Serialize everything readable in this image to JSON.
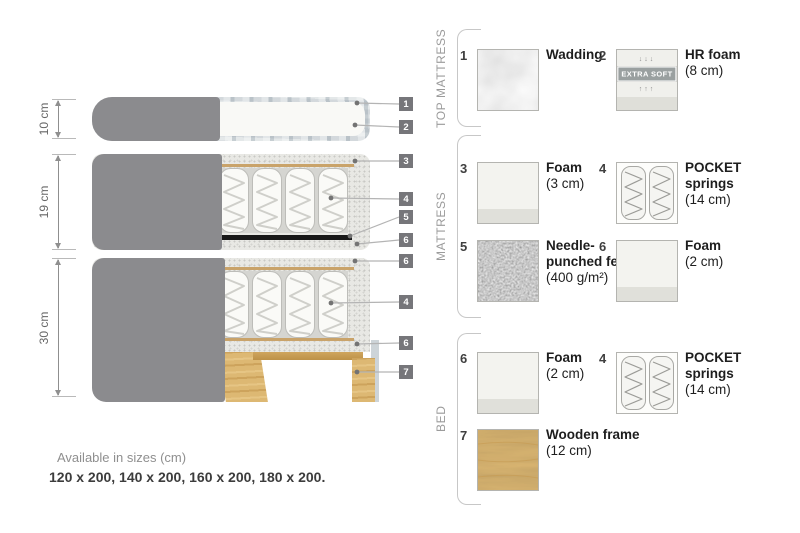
{
  "diagram": {
    "dims": [
      {
        "label": "10 cm"
      },
      {
        "label": "19 cm"
      },
      {
        "label": "30 cm"
      }
    ],
    "tags": [
      {
        "n": "1"
      },
      {
        "n": "2"
      },
      {
        "n": "3"
      },
      {
        "n": "4"
      },
      {
        "n": "5"
      },
      {
        "n": "6"
      },
      {
        "n": "6"
      },
      {
        "n": "4"
      },
      {
        "n": "6"
      },
      {
        "n": "7"
      }
    ]
  },
  "legend": {
    "sections": [
      {
        "title": "TOP MATTRESS",
        "items": [
          {
            "num": "1",
            "name": "Wadding",
            "detail": ""
          },
          {
            "num": "2",
            "name": "HR foam",
            "detail": "(8 cm)",
            "badge": "EXTRA SOFT",
            "arrows_down": "↓↓↓",
            "arrows_up": "↑↑↑"
          }
        ]
      },
      {
        "title": "MATTRESS",
        "items": [
          {
            "num": "3",
            "name": "Foam",
            "detail": "(3 cm)"
          },
          {
            "num": "4",
            "name": "POCKET springs",
            "detail": "(14 cm)"
          },
          {
            "num": "5",
            "name": "Needle-punched felt",
            "detail": "(400 g/m²)"
          },
          {
            "num": "6",
            "name": "Foam",
            "detail": "(2 cm)"
          }
        ]
      },
      {
        "title": "BED",
        "items": [
          {
            "num": "6",
            "name": "Foam",
            "detail": "(2 cm)"
          },
          {
            "num": "4",
            "name": "POCKET springs",
            "detail": "(14 cm)"
          },
          {
            "num": "7",
            "name": "Wooden frame",
            "detail": "(12 cm)"
          }
        ]
      }
    ]
  },
  "swatches": {
    "wadding": "soft white wadding texture",
    "hr_foam": "white foam block with EXTRA SOFT label",
    "foam": "white foam block",
    "pocket_springs": "two fabric spring pockets",
    "felt": "dark gray needle-punched felt",
    "wood": "pine wood grain"
  },
  "colors": {
    "fabric_gray": "#8b8b8e",
    "foam_speckle": "#e8e8e4",
    "wood_tan": "#ddb873",
    "felt_black": "#181818",
    "tag_gray": "#76767a",
    "wadding_blue_gray": "#ccd2d6"
  },
  "footer": {
    "line1": "Available in sizes (cm)",
    "line2": "120 x 200, 140 x 200, 160 x 200, 180 x 200."
  }
}
